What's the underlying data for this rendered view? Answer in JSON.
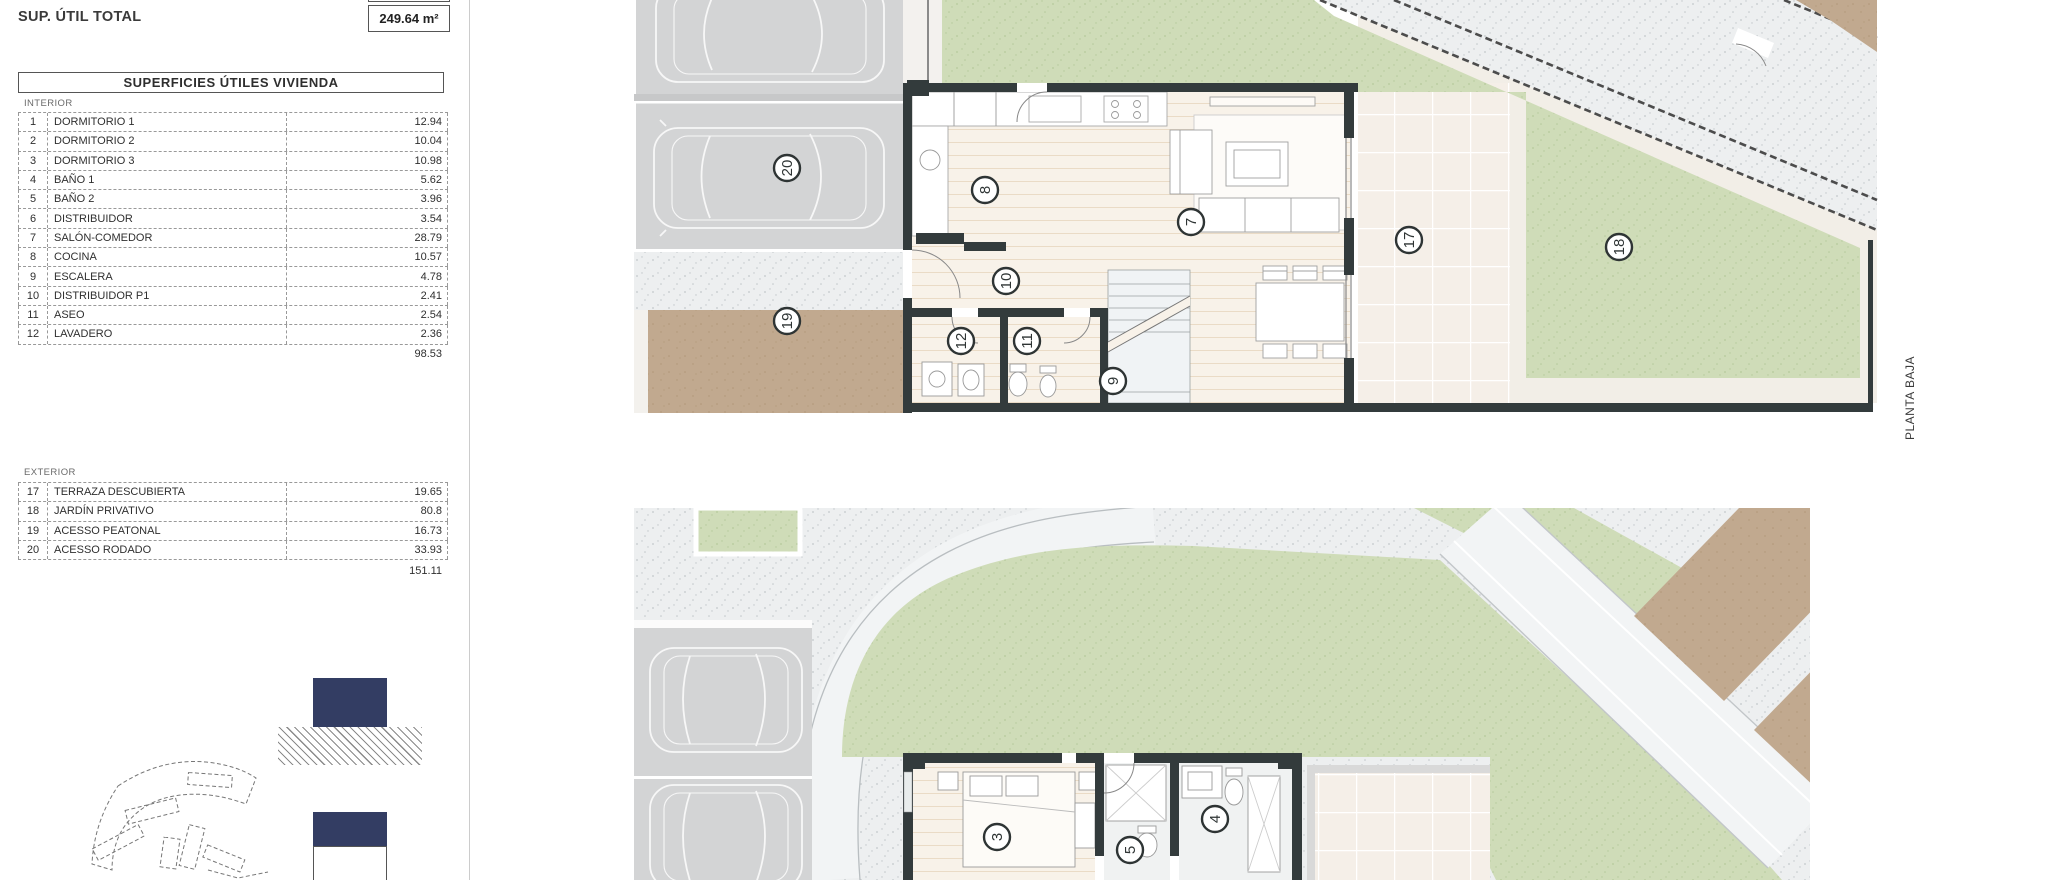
{
  "summary": {
    "construida_label": "SUP. CONSTRUIDA VIVIENDA",
    "total_label": "SUP. ÚTIL TOTAL",
    "total_value": "249.64 m²"
  },
  "table": {
    "title": "SUPERFICIES ÚTILES VIVIENDA",
    "interior": {
      "section_label": "INTERIOR",
      "rows": [
        [
          "1",
          "DORMITORIO 1",
          "12.94"
        ],
        [
          "2",
          "DORMITORIO 2",
          "10.04"
        ],
        [
          "3",
          "DORMITORIO 3",
          "10.98"
        ],
        [
          "4",
          "BAÑO 1",
          "5.62"
        ],
        [
          "5",
          "BAÑO 2",
          "3.96"
        ],
        [
          "6",
          "DISTRIBUIDOR",
          "3.54"
        ],
        [
          "7",
          "SALÓN-COMEDOR",
          "28.79"
        ],
        [
          "8",
          "COCINA",
          "10.57"
        ],
        [
          "9",
          "ESCALERA",
          "4.78"
        ],
        [
          "10",
          "DISTRIBUIDOR P1",
          "2.41"
        ],
        [
          "11",
          "ASEO",
          "2.54"
        ],
        [
          "12",
          "LAVADERO",
          "2.36"
        ]
      ],
      "subtotal": "98.53"
    },
    "exterior": {
      "section_label": "EXTERIOR",
      "rows": [
        [
          "17",
          "TERRAZA DESCUBIERTA",
          "19.65"
        ],
        [
          "18",
          "JARDÍN PRIVATIVO",
          "80.8"
        ],
        [
          "19",
          "ACESSO PEATONAL",
          "16.73"
        ],
        [
          "20",
          "ACESSO RODADO",
          "33.93"
        ]
      ],
      "subtotal": "151.11"
    }
  },
  "plans": {
    "planta_label": "PLANTA BAJA",
    "ground_floor_markers": [
      {
        "n": "20",
        "x": 153,
        "y": 168
      },
      {
        "n": "19",
        "x": 153,
        "y": 321
      },
      {
        "n": "8",
        "x": 351,
        "y": 190
      },
      {
        "n": "10",
        "x": 372,
        "y": 281
      },
      {
        "n": "12",
        "x": 327,
        "y": 341
      },
      {
        "n": "11",
        "x": 393,
        "y": 341
      },
      {
        "n": "7",
        "x": 557,
        "y": 222
      },
      {
        "n": "9",
        "x": 479,
        "y": 381
      },
      {
        "n": "17",
        "x": 775,
        "y": 240
      },
      {
        "n": "18",
        "x": 985,
        "y": 247
      }
    ],
    "first_floor_markers": [
      {
        "n": "3",
        "x": 363,
        "y": 329
      },
      {
        "n": "5",
        "x": 496,
        "y": 342
      },
      {
        "n": "4",
        "x": 581,
        "y": 311
      }
    ]
  },
  "colors": {
    "accent_navy": "#333d63",
    "wall_dark": "#333b3c",
    "garden_green": "#cfdcb8",
    "paving_gray": "#d3d4d5",
    "path_tan": "#c1a98f"
  }
}
